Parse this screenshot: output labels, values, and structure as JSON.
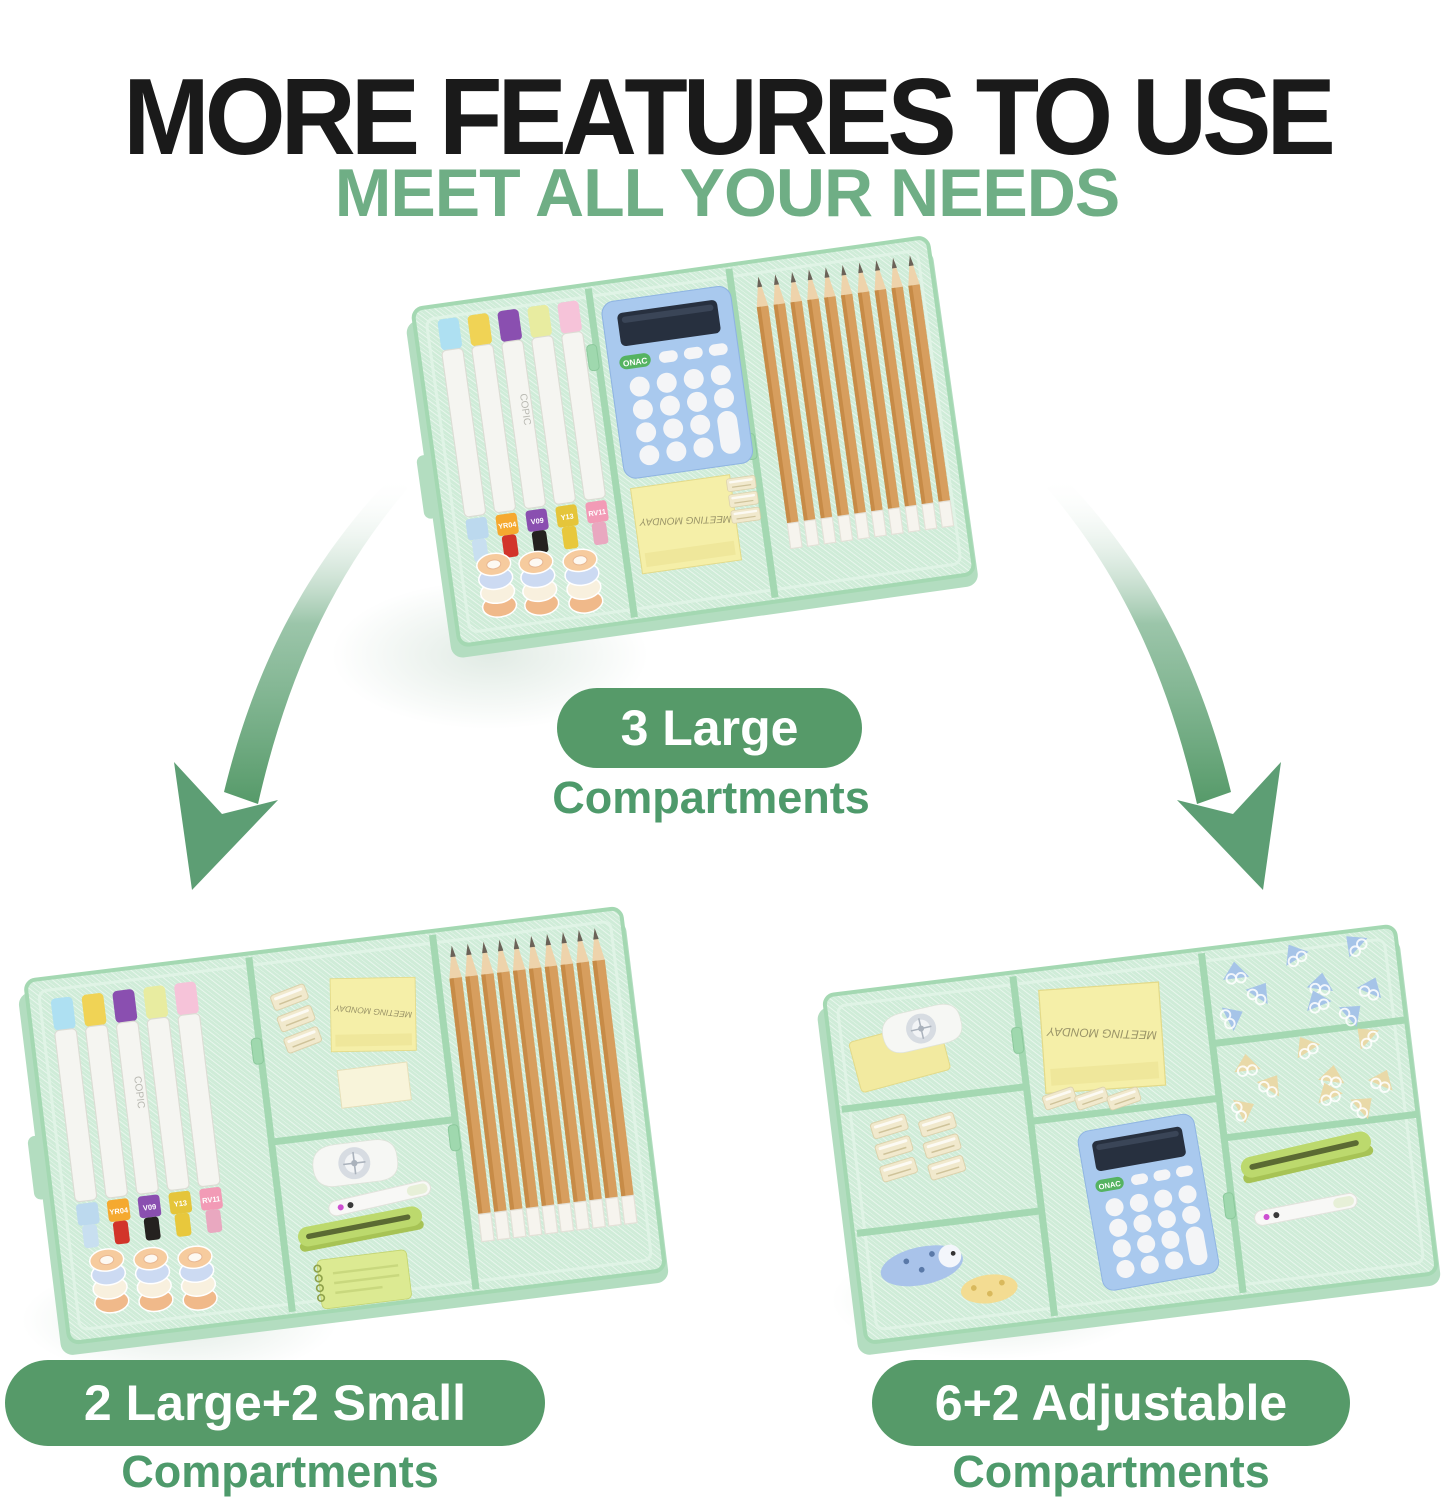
{
  "header": {
    "title": "MORE FEATURES TO USE",
    "subtitle": "MEET ALL YOUR NEEDS"
  },
  "configurations": [
    {
      "badge": "3 Large",
      "caption": "Compartments"
    },
    {
      "badge": "2 Large+2 Small",
      "caption": "Compartments"
    },
    {
      "badge": "6+2 Adjustable",
      "caption": "Compartments"
    }
  ],
  "photo_texts": {
    "marker_brand": "COPIC",
    "marker_caps": [
      "YR04",
      "V09",
      "Y13",
      "RV11"
    ],
    "calculator_brand": "ONAC",
    "sticky_note_writing": "MEETING MONDAY"
  },
  "colors": {
    "title_color": "#1a1a1a",
    "subtitle_green": "#6fae85",
    "badge_green": "#569a69",
    "caption_green": "#4e9a6b",
    "arrow_green": "#5d9e74",
    "tray_mint": "#cfecd8",
    "tray_wall": "#a4d8b2"
  }
}
